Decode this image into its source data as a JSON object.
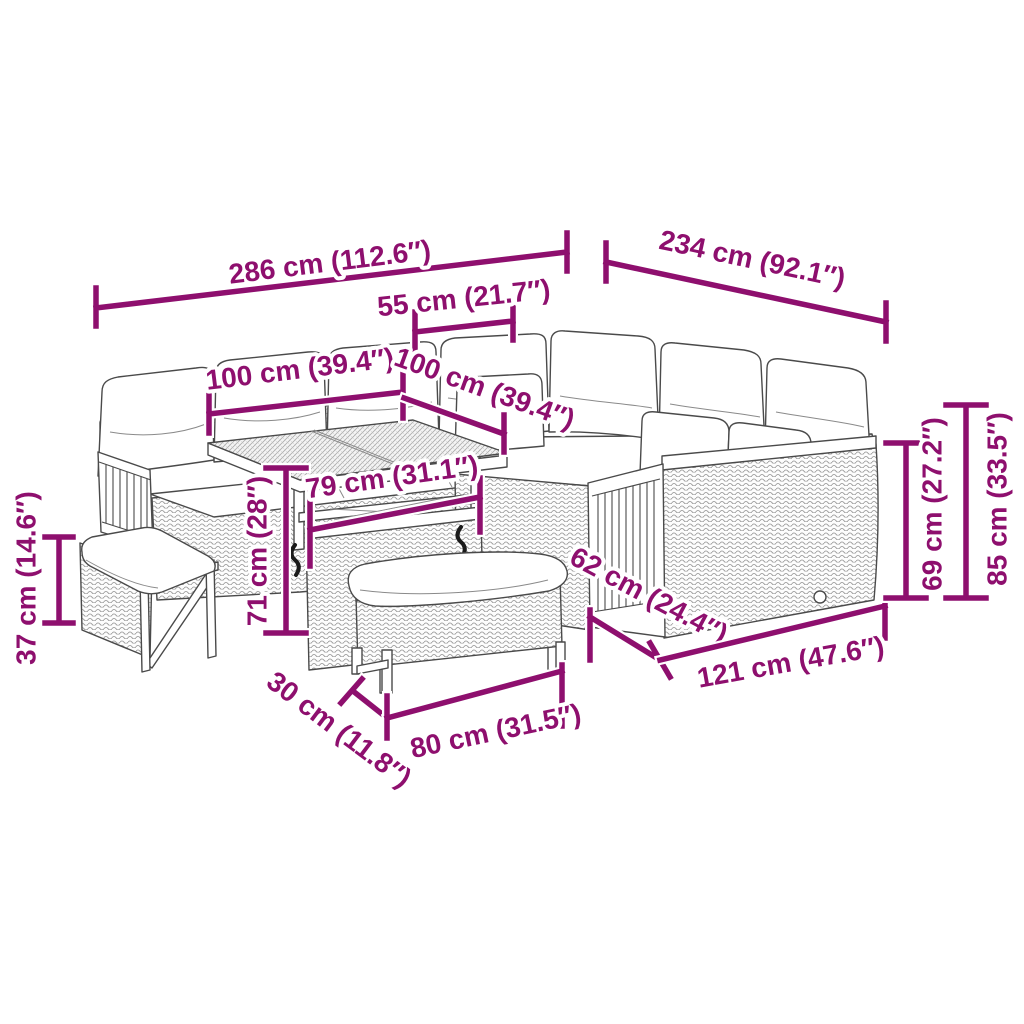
{
  "diagram": {
    "kind": "furniture-dimension-diagram",
    "background_color": "#FFFFFF",
    "dimension_color": "#8E0F6E",
    "artwork_line_color": "#4A4A4A"
  },
  "dimensions": [
    {
      "id": "overall-width",
      "label": "286 cm (112.6″)"
    },
    {
      "id": "overall-depth",
      "label": "234 cm (92.1″)"
    },
    {
      "id": "corner-section-width",
      "label": "55 cm (21.7″)"
    },
    {
      "id": "left-sofa-width",
      "label": "100 cm (39.4″)"
    },
    {
      "id": "right-sofa-width",
      "label": "100 cm (39.4″)"
    },
    {
      "id": "table-top-width",
      "label": "79 cm (31.1″)"
    },
    {
      "id": "table-height",
      "label": "71 cm (28″)"
    },
    {
      "id": "bench-height",
      "label": "37 cm (14.6″)"
    },
    {
      "id": "bench-depth",
      "label": "30 cm (11.8″)"
    },
    {
      "id": "bench-width",
      "label": "80 cm (31.5″)"
    },
    {
      "id": "seat-depth",
      "label": "62 cm (24.4″)"
    },
    {
      "id": "sofa-module-width",
      "label": "121 cm (47.6″)"
    },
    {
      "id": "backrest-height",
      "label": "69 cm (27.2″)"
    },
    {
      "id": "overall-height",
      "label": "85 cm (33.5″)"
    }
  ]
}
